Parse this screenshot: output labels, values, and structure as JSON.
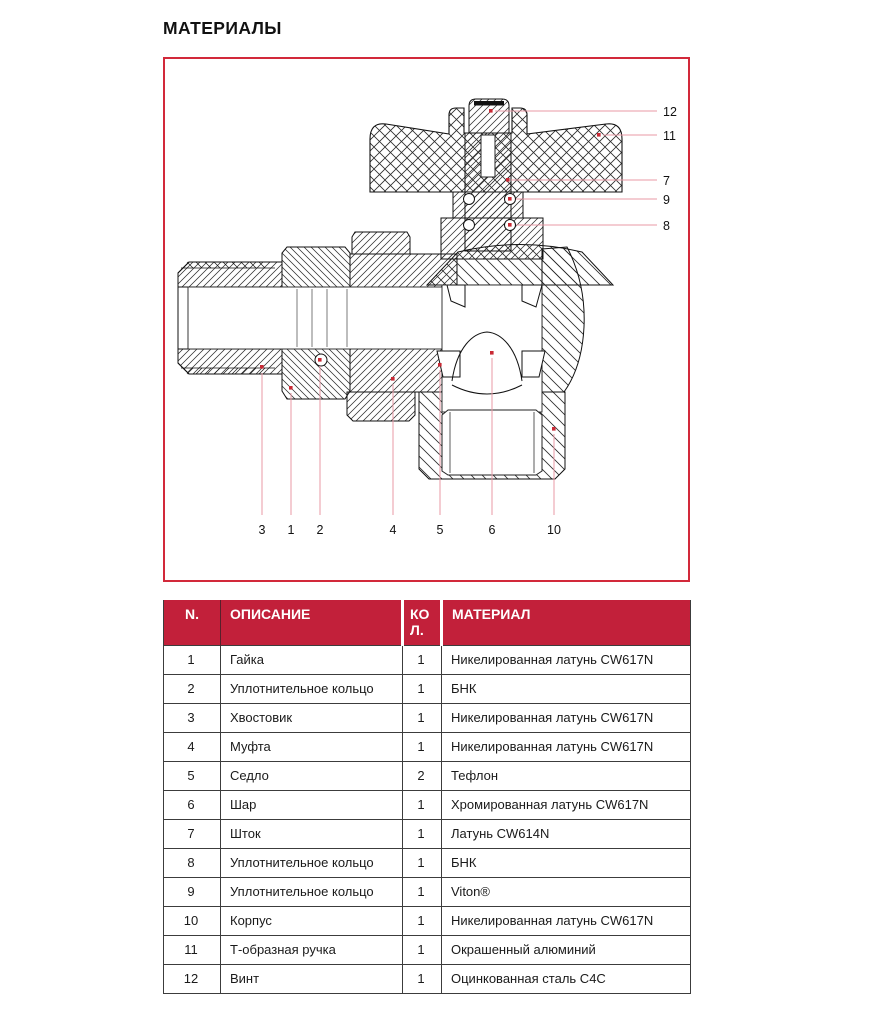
{
  "page": {
    "title": "МАТЕРИАЛЫ"
  },
  "colors": {
    "header_red": "#c2203a",
    "figure_border_red": "#d2293a",
    "leader_line_pink": "#e89aa6",
    "leader_dot_red": "#c92a35"
  },
  "figure": {
    "kind": "valve cross-section technical drawing",
    "callouts": {
      "right": [
        {
          "label": "12"
        },
        {
          "label": "11"
        },
        {
          "label": "7"
        },
        {
          "label": "9"
        },
        {
          "label": "8"
        }
      ],
      "bottom": [
        {
          "label": "3"
        },
        {
          "label": "1"
        },
        {
          "label": "2"
        },
        {
          "label": "4"
        },
        {
          "label": "5"
        },
        {
          "label": "6"
        },
        {
          "label": "10"
        }
      ]
    }
  },
  "table": {
    "headers": [
      "N.",
      "ОПИСАНИЕ",
      "КОЛ.",
      "МАТЕРИАЛ"
    ],
    "rows": [
      {
        "n": "1",
        "desc": "Гайка",
        "qty": "1",
        "material": "Никелированная латунь CW617N"
      },
      {
        "n": "2",
        "desc": "Уплотнительное кольцо",
        "qty": "1",
        "material": "БНК"
      },
      {
        "n": "3",
        "desc": "Хвостовик",
        "qty": "1",
        "material": "Никелированная латунь CW617N"
      },
      {
        "n": "4",
        "desc": "Муфта",
        "qty": "1",
        "material": "Никелированная латунь CW617N"
      },
      {
        "n": "5",
        "desc": "Седло",
        "qty": "2",
        "material": "Тефлон"
      },
      {
        "n": "6",
        "desc": "Шар",
        "qty": "1",
        "material": "Хромированная латунь CW617N"
      },
      {
        "n": "7",
        "desc": "Шток",
        "qty": "1",
        "material": "Латунь CW614N"
      },
      {
        "n": "8",
        "desc": "Уплотнительное кольцо",
        "qty": "1",
        "material": "БНК"
      },
      {
        "n": "9",
        "desc": "Уплотнительное кольцо",
        "qty": "1",
        "material": "Viton®"
      },
      {
        "n": "10",
        "desc": "Корпус",
        "qty": "1",
        "material": "Никелированная латунь CW617N"
      },
      {
        "n": "11",
        "desc": "Т-образная ручка",
        "qty": "1",
        "material": "Окрашенный алюминий"
      },
      {
        "n": "12",
        "desc": "Винт",
        "qty": "1",
        "material": "Оцинкованная сталь C4C"
      }
    ]
  }
}
